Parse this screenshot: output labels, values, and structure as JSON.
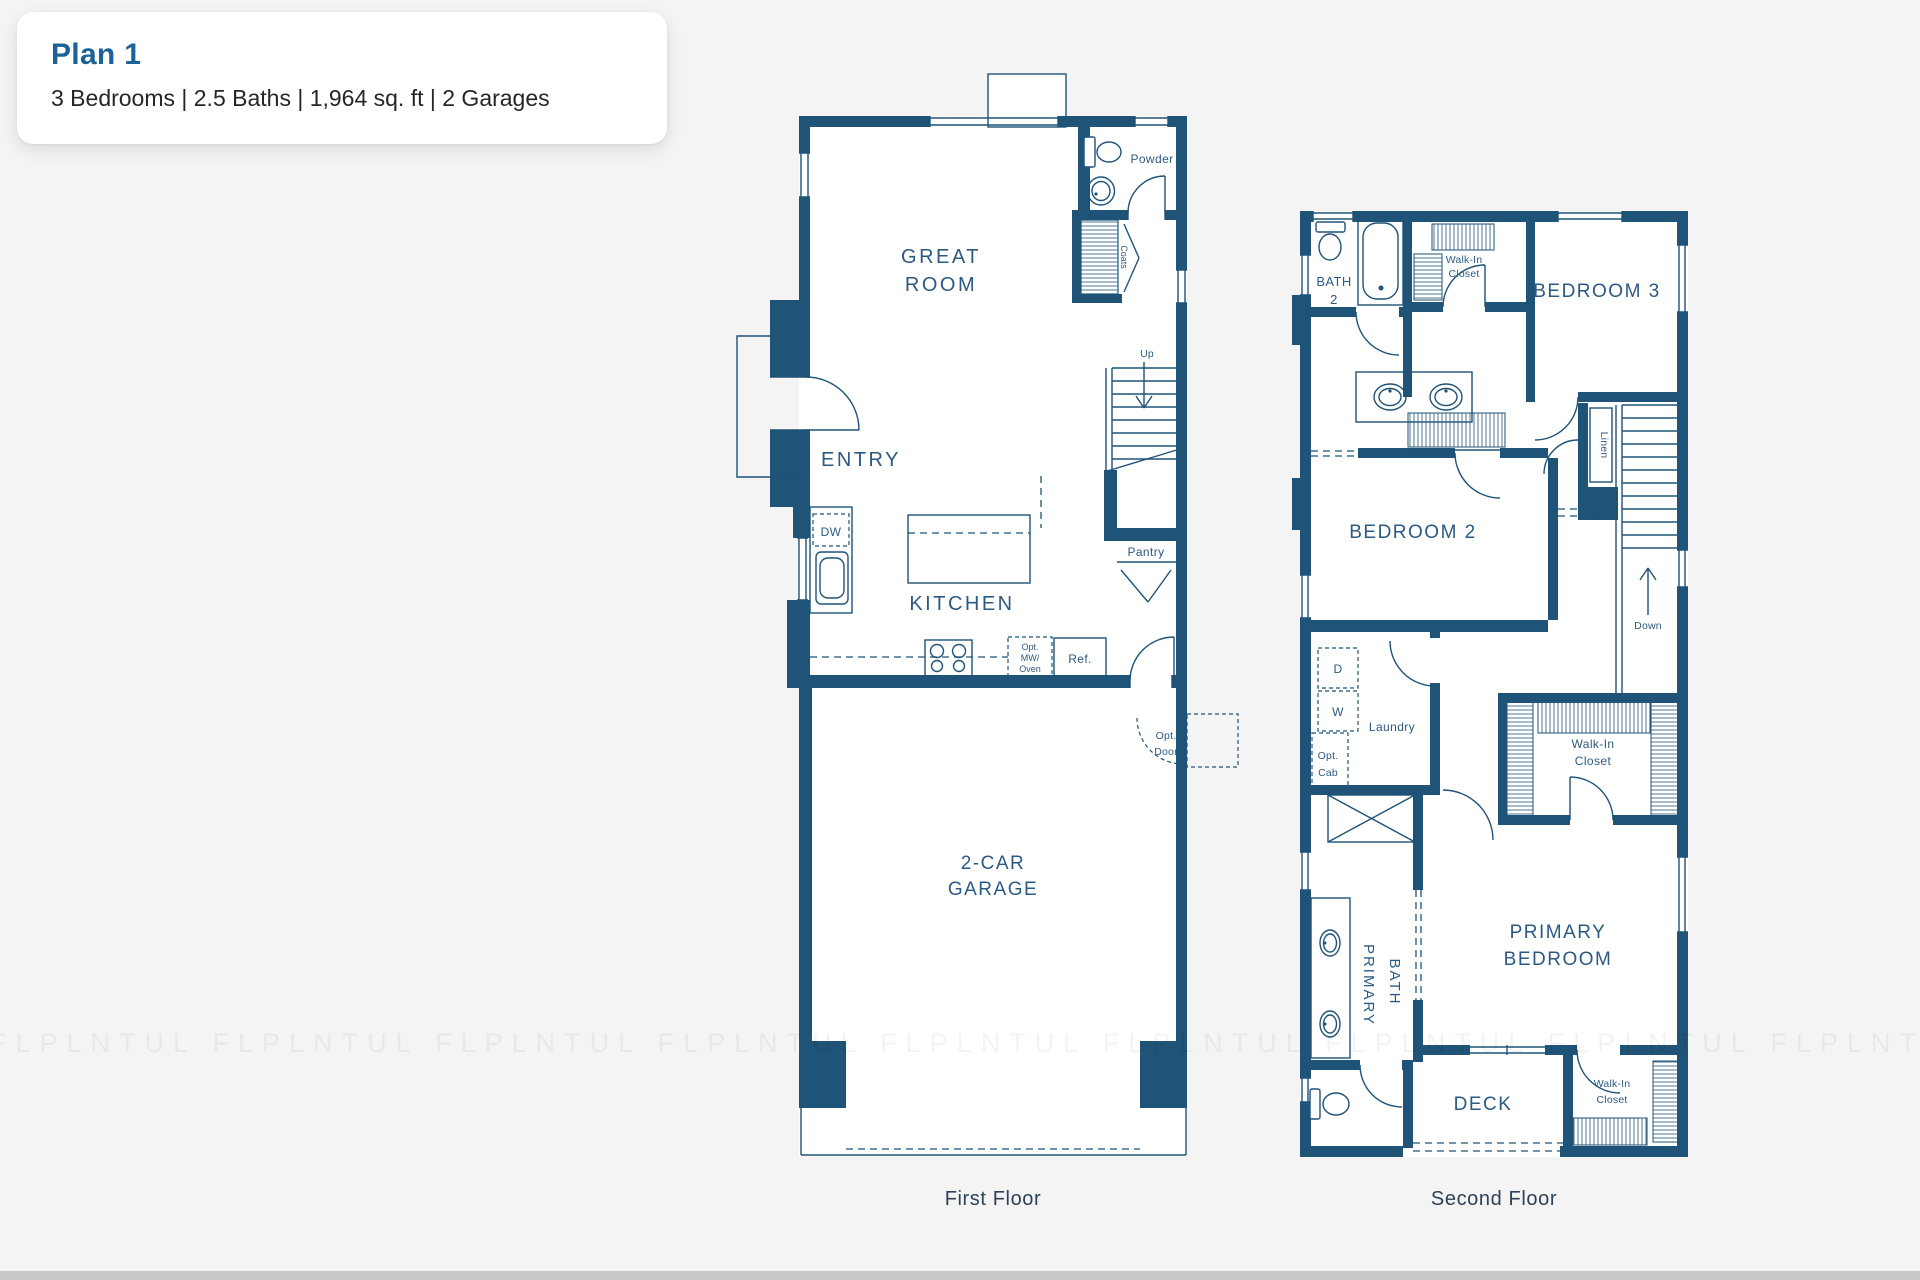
{
  "header": {
    "title": "Plan 1",
    "subtitle": "3 Bedrooms | 2.5 Baths | 1,964 sq. ft | 2 Garages"
  },
  "first_floor": {
    "caption": "First Floor",
    "labels": {
      "great_room": [
        "GREAT",
        "ROOM"
      ],
      "entry": "ENTRY",
      "kitchen": "KITCHEN",
      "garage": [
        "2-CAR",
        "GARAGE"
      ],
      "powder": "Powder",
      "coats": "Coats",
      "up": "Up",
      "pantry": "Pantry",
      "dw": "DW",
      "opt_mw_oven": [
        "Opt.",
        "MW/",
        "Oven"
      ],
      "ref": "Ref.",
      "opt_door": [
        "Opt.",
        "Door"
      ]
    }
  },
  "second_floor": {
    "caption": "Second Floor",
    "labels": {
      "bath2": [
        "BATH",
        "2"
      ],
      "walk_in_closet_bedroom3": [
        "Walk-In",
        "Closet"
      ],
      "bedroom3": "BEDROOM 3",
      "bedroom2": "BEDROOM 2",
      "linen": "Linen",
      "down": "Down",
      "dryer": "D",
      "washer": "W",
      "laundry": "Laundry",
      "opt_cab": [
        "Opt.",
        "Cab"
      ],
      "walk_in_closet_primary": [
        "Walk-In",
        "Closet"
      ],
      "primary_bath": [
        "PRIMARY",
        "BATH"
      ],
      "primary_bedroom": [
        "PRIMARY",
        "BEDROOM"
      ],
      "deck": "DECK",
      "walk_in_closet_deck": [
        "Walk-In",
        "Closet"
      ]
    }
  },
  "watermark": {
    "text": "FLPLNTUL   FLPLNTUL   FLPLNTUL   FLPLNTUL   FLPLNTUL   FLPLNTUL   FLPLNTUL   FLPLNTUL   FLPLNTUL   FLPLNTUL"
  },
  "colors": {
    "wall": "#1f5377",
    "accent": "#1a6298",
    "page_bg": "#f4f4f4",
    "caption_text": "#2e4257"
  }
}
